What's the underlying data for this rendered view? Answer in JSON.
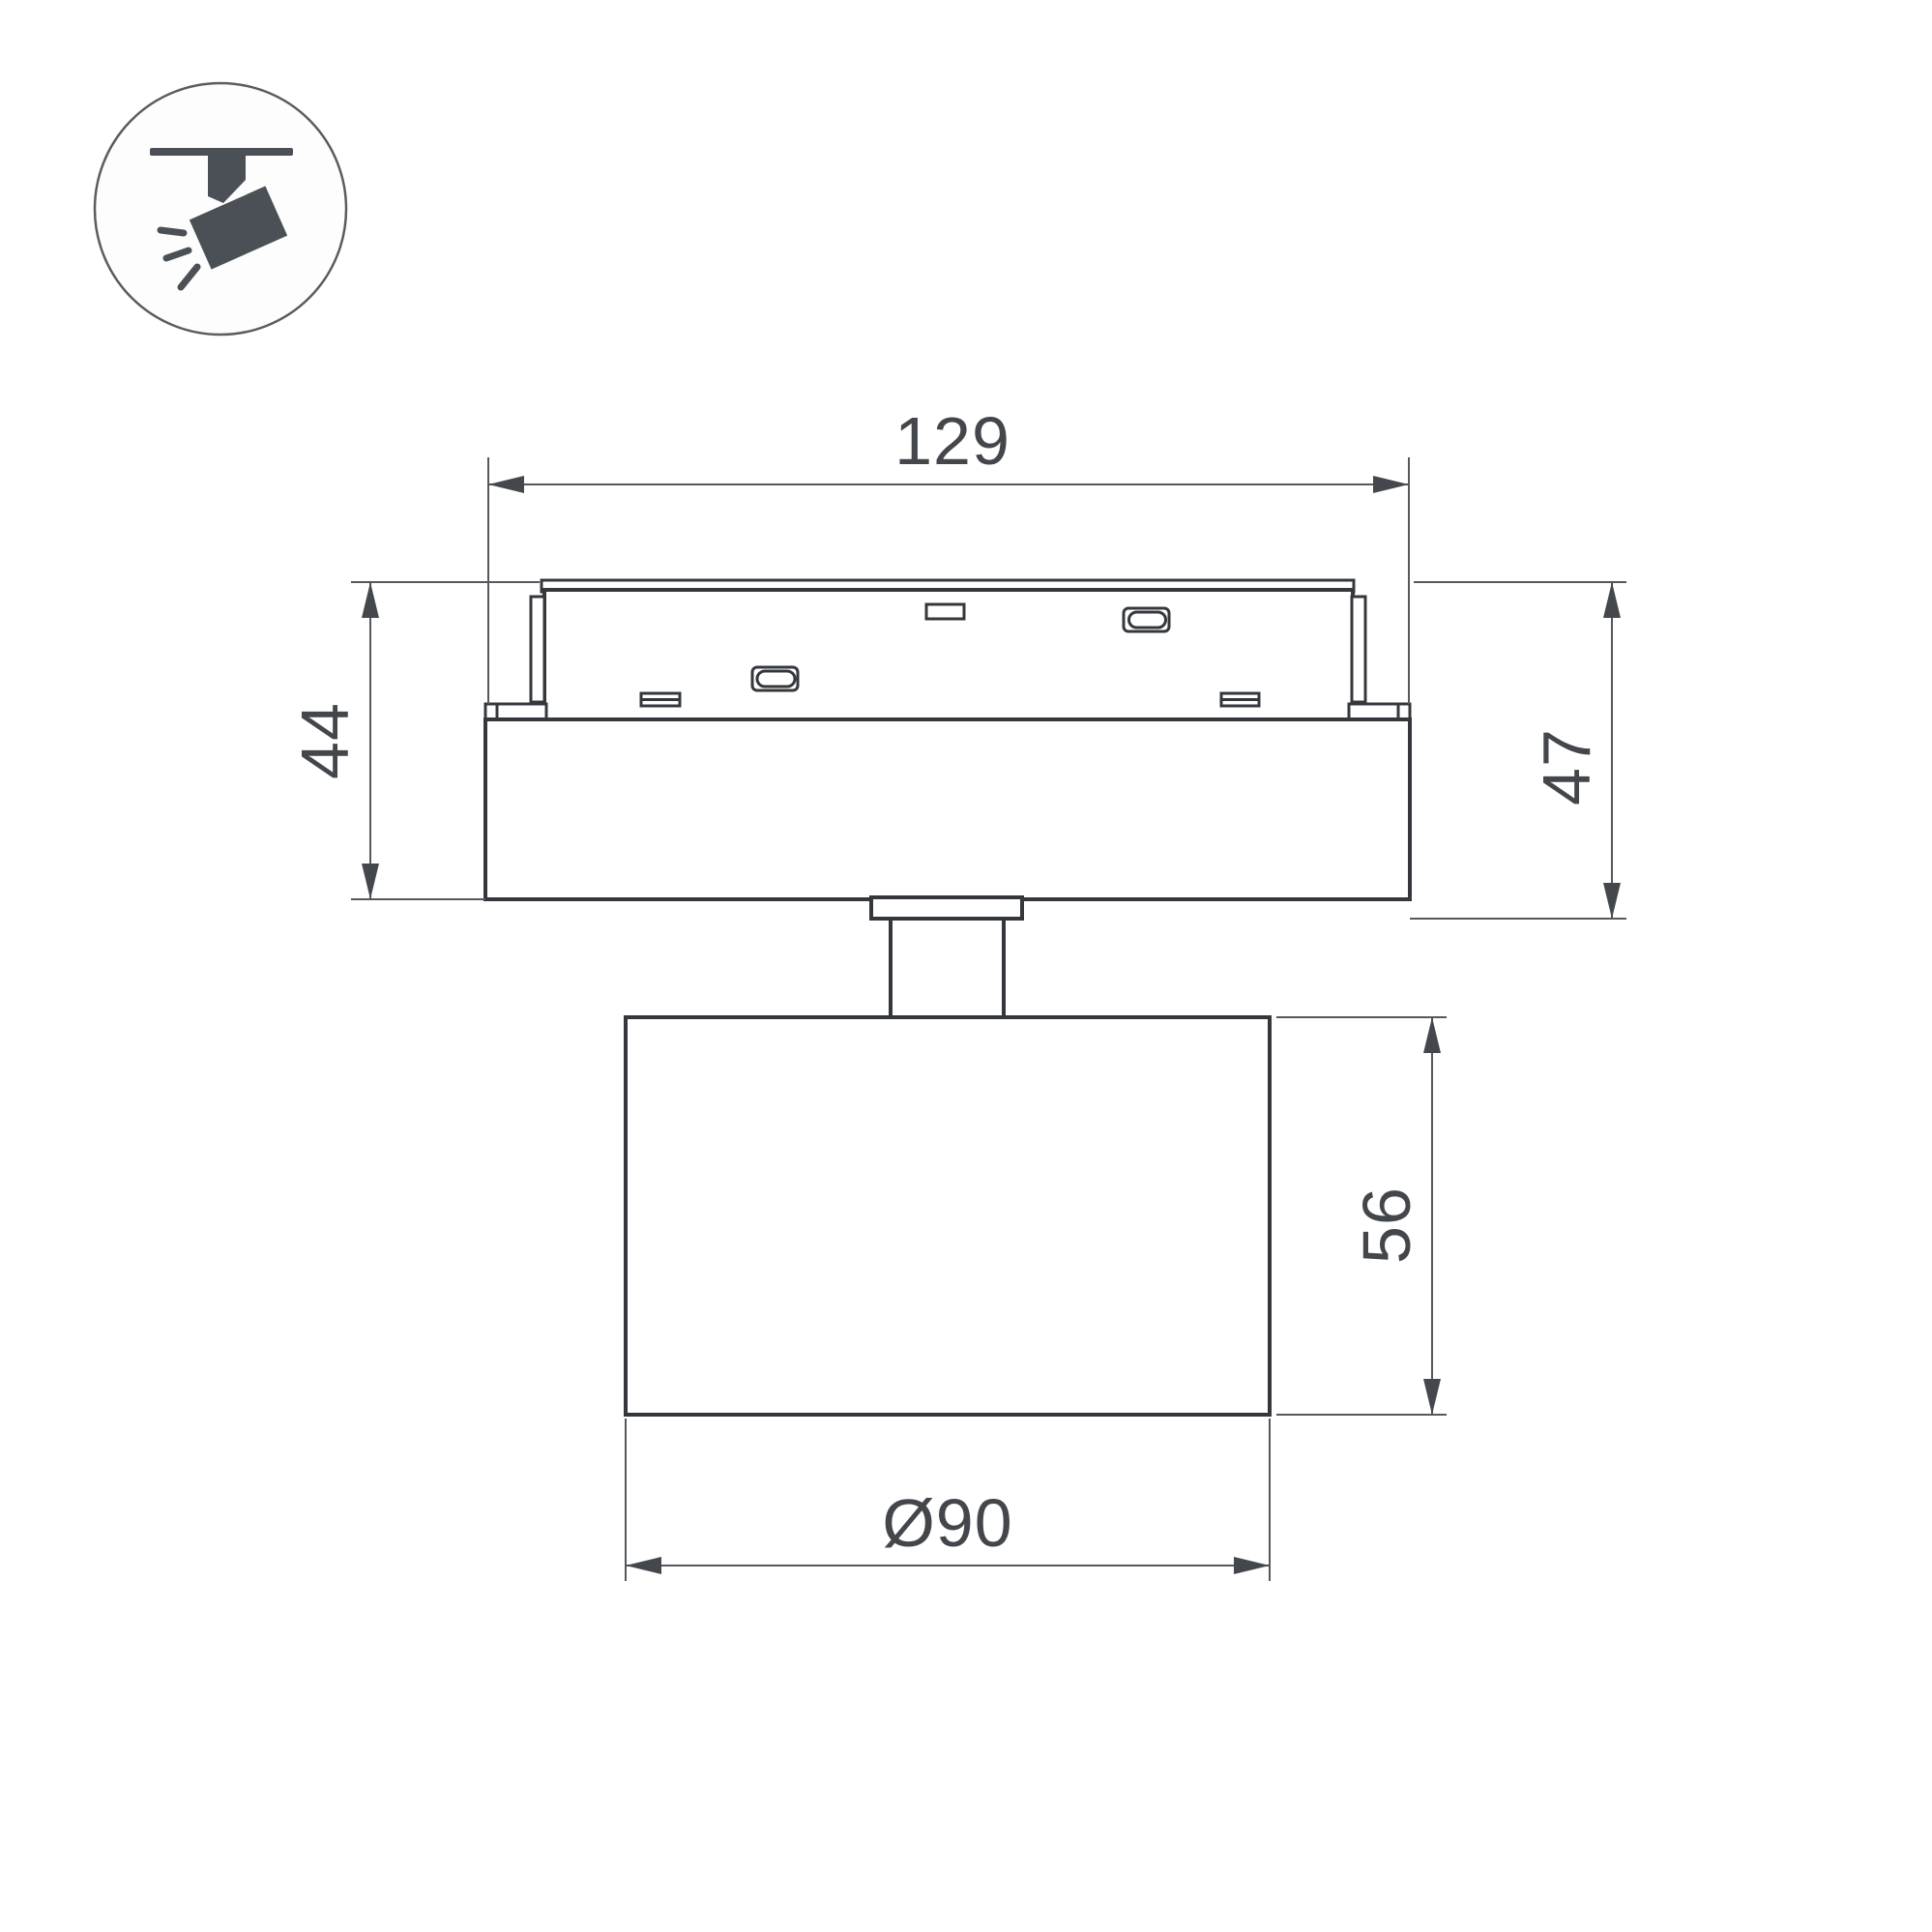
{
  "drawing": {
    "title": "track spotlight dimension drawing",
    "dimensions": {
      "adapter_width": "129",
      "adapter_height_left": "44",
      "adapter_height_right": "47",
      "head_height": "56",
      "head_diameter": "Ø90"
    },
    "icon": "ceiling-track-spotlight",
    "colors": {
      "background": "#ffffff",
      "object_line": "#34383d",
      "dimension_line": "#55595e",
      "label_text": "#43474c",
      "icon_fill": "#4a5056"
    }
  }
}
